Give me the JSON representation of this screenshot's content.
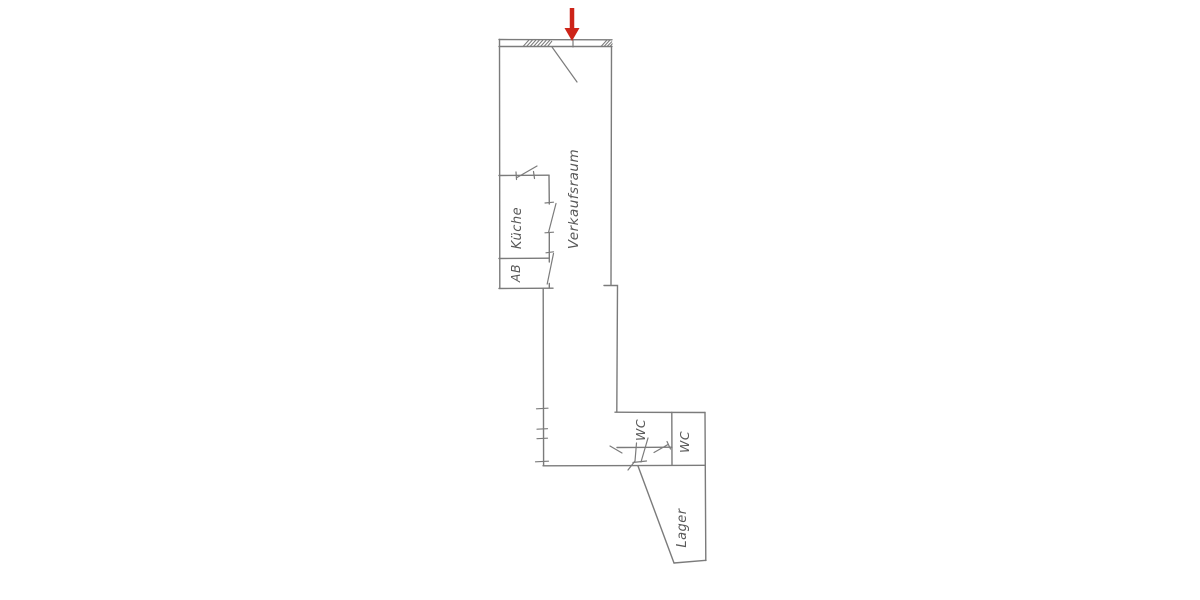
{
  "canvas": {
    "background": "#ffffff"
  },
  "floor_plan": {
    "kind": "hand-drawn architectural floor plan",
    "line_color": "#7b7b7b",
    "label_color": "#585858",
    "rooms": {
      "verkaufsraum": {
        "label": "Verkaufsraum"
      },
      "kueche": {
        "label": "Küche"
      },
      "ab": {
        "label": "AB"
      },
      "wc_left": {
        "label": "WC"
      },
      "wc_right": {
        "label": "WC"
      },
      "lager": {
        "label": "Lager"
      }
    },
    "annotations": {
      "entrance_arrow": {
        "icon": "arrow-down-icon",
        "color": "#cd2418"
      }
    }
  }
}
